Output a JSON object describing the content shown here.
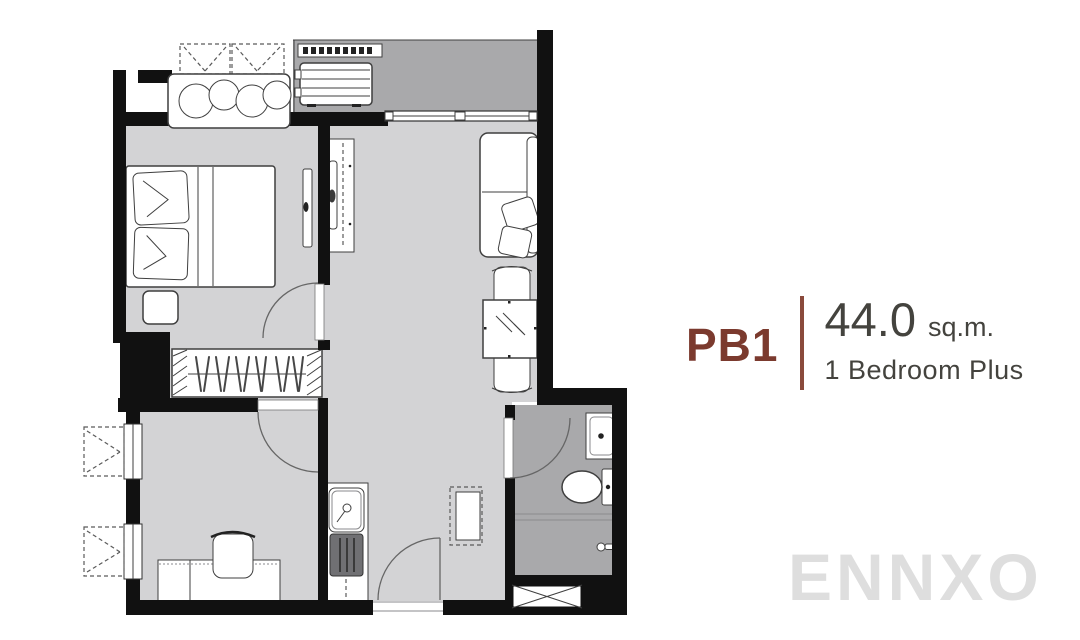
{
  "unit_info": {
    "code": "PB1",
    "area_value": "44.0",
    "area_unit": "sq.m.",
    "type": "1 Bedroom Plus"
  },
  "watermark": "ENNXO",
  "colors": {
    "unit_code": "#7b3a2e",
    "divider": "#8a4a3c",
    "info_text": "#44433e",
    "watermark": "#dedede",
    "wall": "#111111",
    "floor": "#d3d3d5",
    "floor_dark": "#a9a9ab"
  },
  "floorplan": {
    "rooms": [
      "balcony",
      "bedroom",
      "living-dining",
      "wardrobe",
      "plus-room",
      "kitchen",
      "bathroom",
      "entrance"
    ],
    "fixtures": [
      "ac-condenser-unit",
      "planter-plants",
      "double-bed",
      "pillows",
      "nightstand",
      "bedroom-tv",
      "tv-console",
      "sofa",
      "dining-table",
      "dining-chairs",
      "clothes-hangers",
      "desk",
      "desk-chair",
      "kitchen-sink",
      "refrigerator",
      "washbasin",
      "toilet",
      "shower",
      "service-shaft"
    ]
  }
}
